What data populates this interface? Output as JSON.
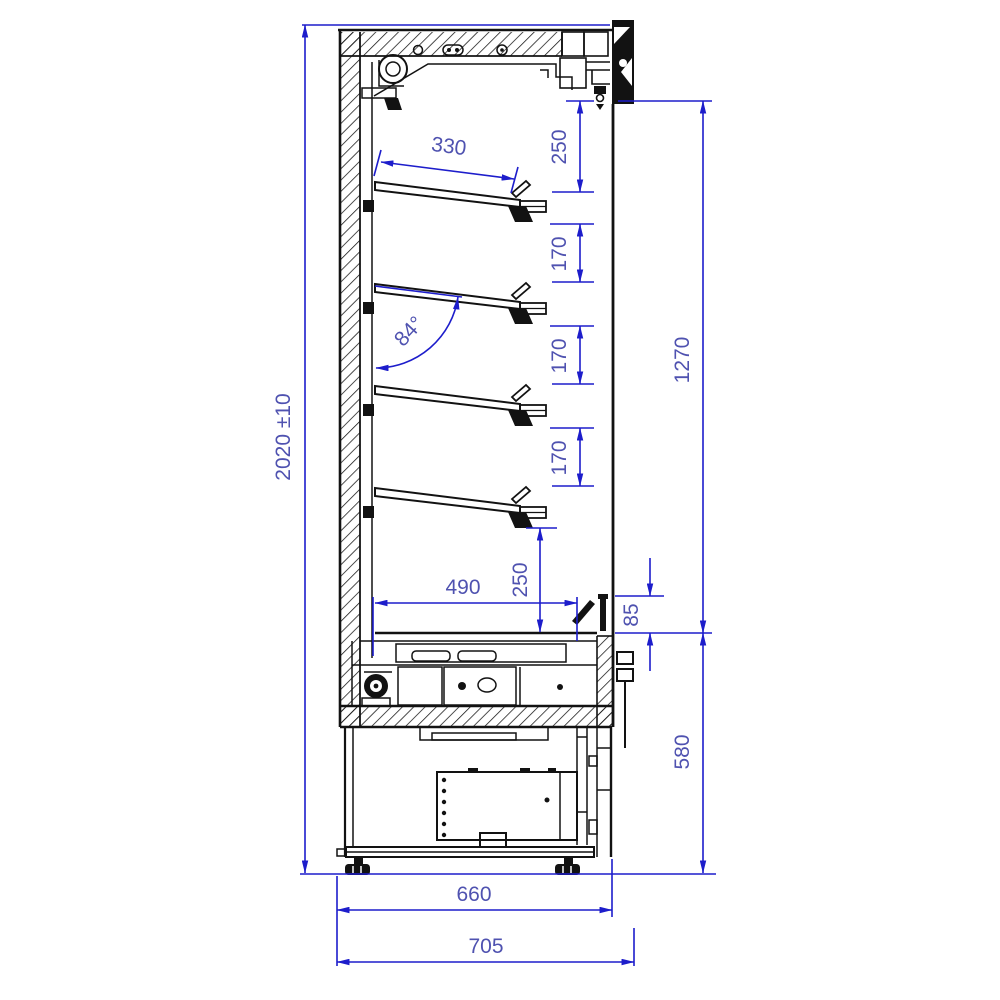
{
  "diagram": {
    "type": "technical-drawing",
    "subject": "refrigerated-multideck-display-cabinet-side-section",
    "units": "mm",
    "colors": {
      "dimension_line": "#1d1dcb",
      "dimension_text": "#4f52b0",
      "outline": "#121212",
      "background": "#ffffff"
    },
    "dims": {
      "height_overall": "2020 ±10",
      "shelf_depth": "330",
      "top_gap": "250",
      "shelf_gap_a": "170",
      "shelf_gap_b": "170",
      "shelf_gap_c": "170",
      "opening_height": "1270",
      "bottom_gap": "250",
      "well_depth": "490",
      "grille_offset": "85",
      "base_height": "580",
      "base_depth": "660",
      "depth_overall": "705",
      "shelf_angle": "84°"
    }
  }
}
